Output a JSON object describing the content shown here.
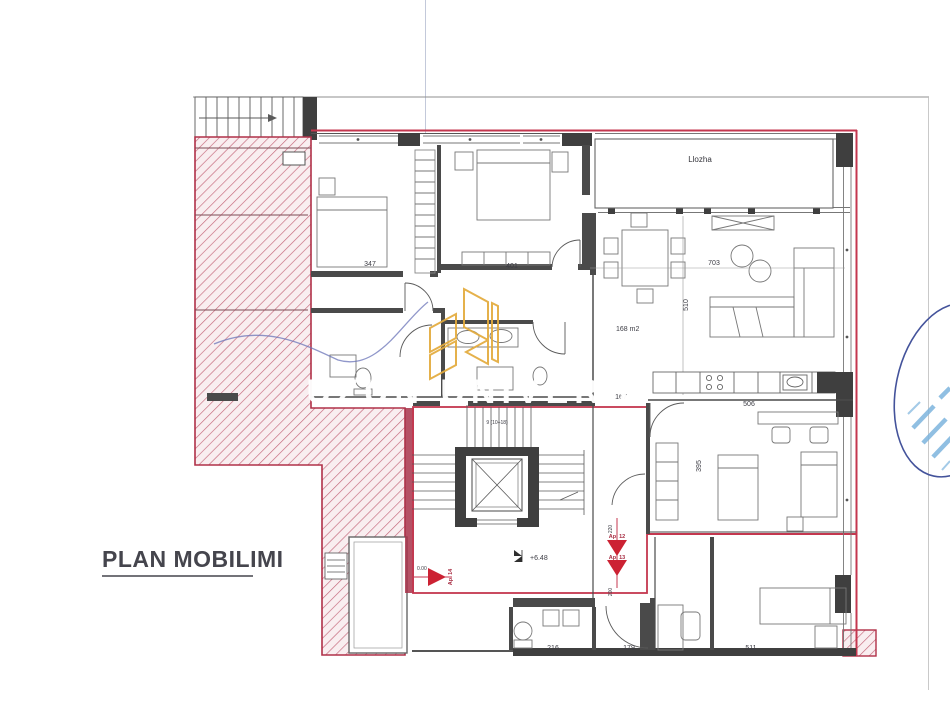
{
  "drawing": {
    "title": "PLAN MOBILIMI",
    "watermark_text": "UZUN UNIVERS",
    "rooms": {
      "loggia": "Llozha",
      "area_total": "168 m2"
    },
    "dimensions": {
      "bed1": "347",
      "bed2": "401",
      "living_w": "703",
      "living_h": "510",
      "hall": "167",
      "kitchen": "506",
      "study": "395",
      "bath": "216",
      "corridor": "179",
      "bed3": "511",
      "d220": "220",
      "d200": "200"
    },
    "levels": {
      "current": "+6.48",
      "zero": "0.00"
    },
    "stairs_note": "9 (10÷18)",
    "apartments": {
      "ap12": "Ap. 12",
      "ap13": "Ap. 13",
      "ap14": "Ap. 14"
    },
    "colors": {
      "hatch": "#c4677a",
      "outline_red": "#c4374f",
      "wall": "#3f3f3f",
      "logo_gold": "#e3ab3c",
      "stamp_blue": "#44539b",
      "stamp_light": "#7db4de",
      "pen_blue": "#6b74b8"
    }
  }
}
